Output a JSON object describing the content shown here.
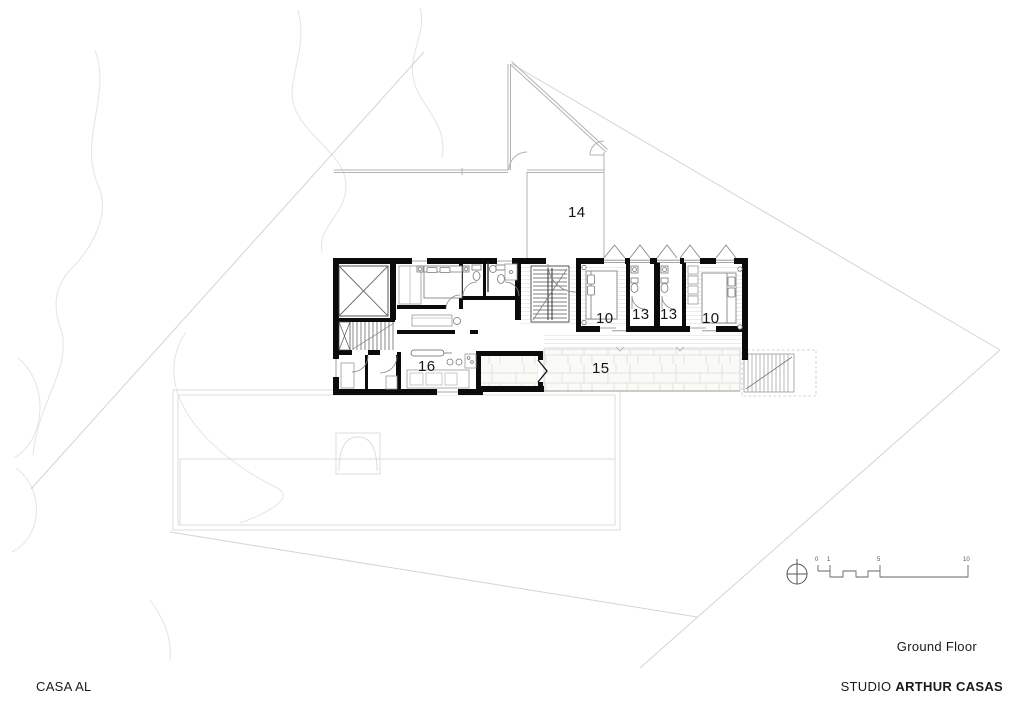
{
  "document": {
    "project_name": "CASA AL",
    "drawing_title": "Ground Floor",
    "studio": {
      "prefix": "STUDIO ",
      "name": "ARTHUR CASAS"
    }
  },
  "room_labels": [
    {
      "id": "room-14",
      "label": "14"
    },
    {
      "id": "room-10-left",
      "label": "10"
    },
    {
      "id": "room-13-left",
      "label": "13"
    },
    {
      "id": "room-13-right",
      "label": "13"
    },
    {
      "id": "room-10-right",
      "label": "10"
    },
    {
      "id": "room-16",
      "label": "16"
    },
    {
      "id": "room-15",
      "label": "15"
    }
  ],
  "scale_bar": {
    "ticks": [
      "0",
      "1",
      "5",
      "10"
    ]
  },
  "symbols": {
    "north": "north-indicator"
  },
  "colors": {
    "walls": "#0b0b0b",
    "site_lines": "#d6d6d6",
    "contour_lines": "#e4e4e4",
    "upper_level_lines": "#b3b3b3",
    "fixture_lines": "#777777",
    "text": "#1a1a1a",
    "paper": "#ffffff"
  }
}
